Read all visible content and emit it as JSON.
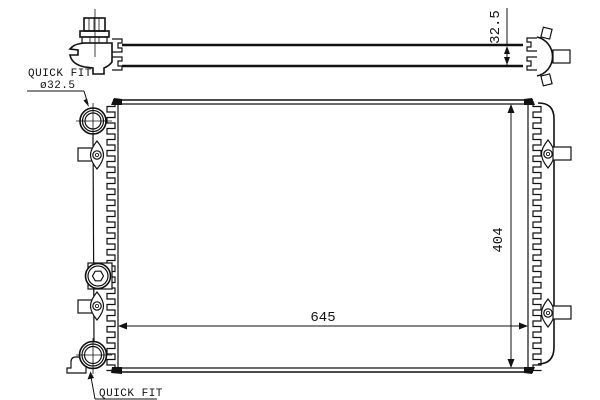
{
  "drawing": {
    "type": "radiator-technical-drawing",
    "dimensions": {
      "core_width": "645",
      "core_height": "404",
      "core_thickness": "32.5"
    },
    "labels": {
      "quick_fit_top": "QUICK FIT",
      "quick_fit_top_diameter": "ø32.5",
      "quick_fit_bottom": "QUICK FIT"
    },
    "colors": {
      "line": "#111111",
      "background": "#ffffff"
    }
  }
}
